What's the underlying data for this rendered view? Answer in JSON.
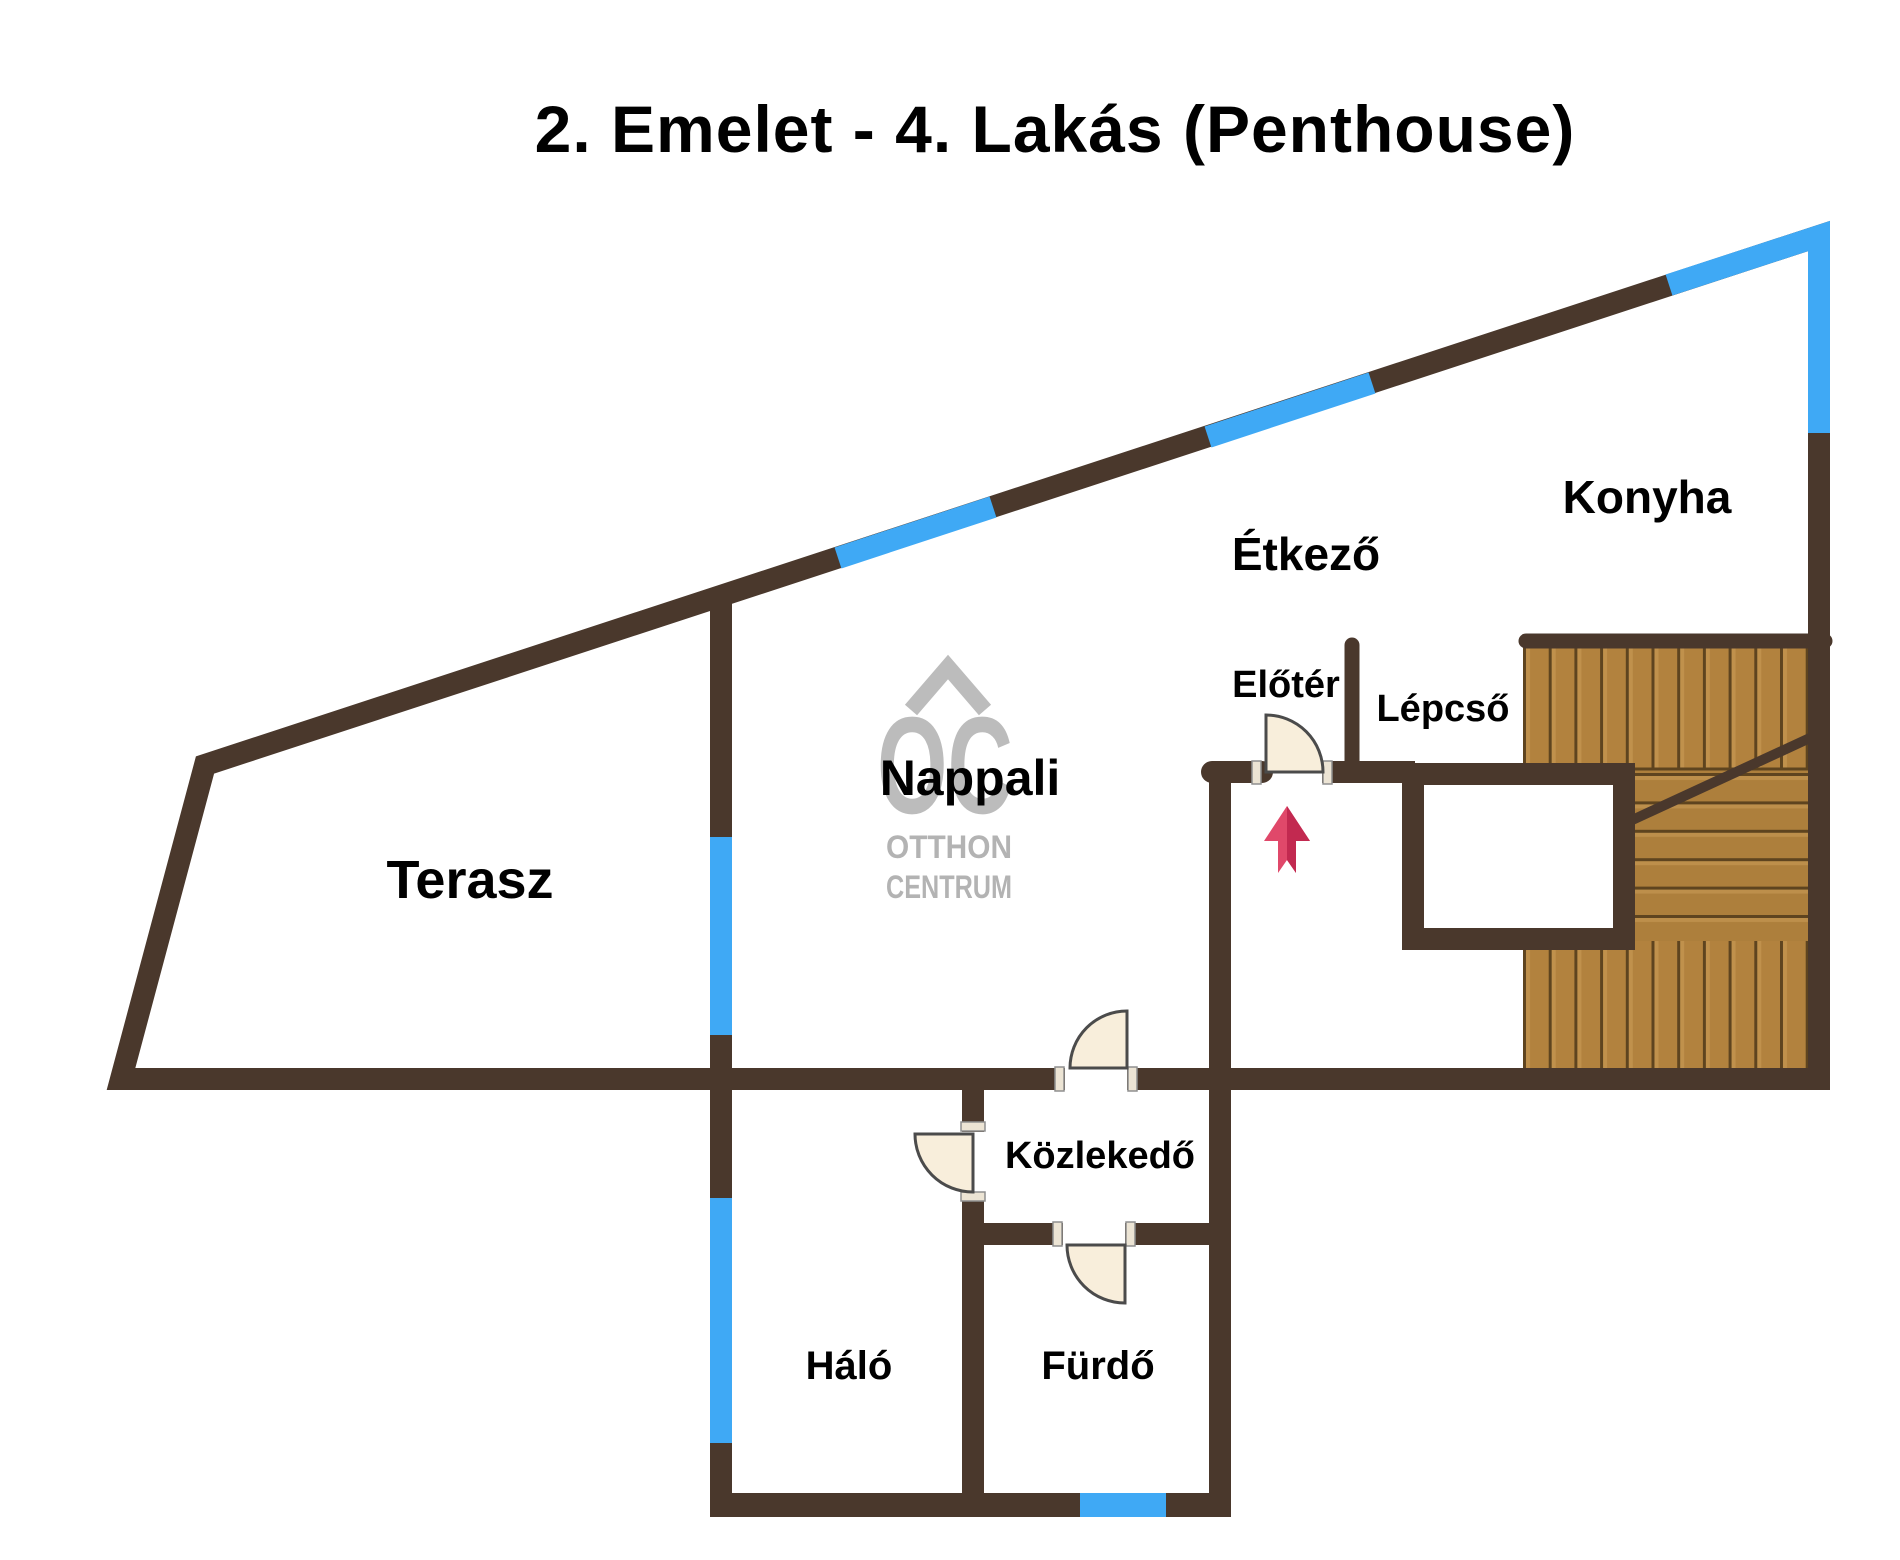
{
  "title": "2. Emelet - 4. Lakás (Penthouse)",
  "rooms": {
    "terasz": "Terasz",
    "nappali": "Nappali",
    "etkezo": "Étkező",
    "konyha": "Konyha",
    "eloter": "Előtér",
    "lepcso": "Lépcső",
    "kozlekedo": "Közlekedő",
    "halo": "Háló",
    "furdo": "Fürdő"
  },
  "watermark": {
    "monogram": "OC",
    "line1": "OTTHON",
    "line2": "CENTRUM"
  },
  "icons": {
    "entry_arrow": "up-arrow",
    "door_symbol": "quarter-circle-door-swing",
    "roof_mark": "house-roof-chevron"
  },
  "colors": {
    "wall": "#4a382c",
    "window": "#3fa9f5",
    "wood": "#b2823e",
    "wood_line": "#5e441f",
    "door_leaf": "#f8eedb",
    "arrow": "#d23558",
    "watermark": "#b9b9b9",
    "text": "#000000",
    "background": "#ffffff"
  }
}
